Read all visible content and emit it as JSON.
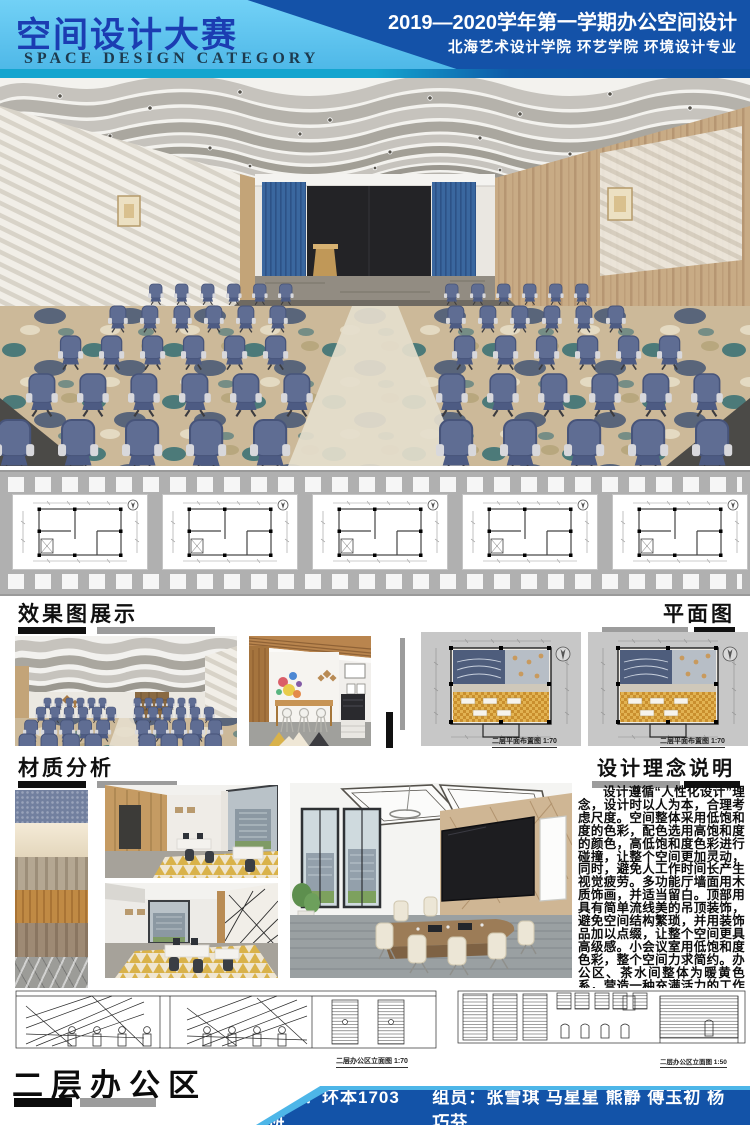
{
  "header": {
    "title_cn": "空间设计大赛",
    "title_en": "SPACE DESIGN CATEGORY",
    "semester_line": "2019—2020学年第一学期办公空间设计",
    "school_line": "北海艺术设计学院  环艺学院  环境设计专业"
  },
  "headings": {
    "renders": "效果图展示",
    "plans": "平面图",
    "materials": "材质分析",
    "concept": "设计理念说明",
    "area": "二层办公区"
  },
  "concept": {
    "paragraph": "设计遵循“人性化设计”理念，设计时以人为本，合理考虑尺度。空间整体采用低饱和度的色彩，配色选用高饱和度的颜色，高低饱和度色彩进行碰撞，让整个空间更加灵动，同时，避免人工作时间长产生视觉疲劳。多功能厅墙面用木质饰画，并适当留白。顶部用具有简单流线美的吊顶装饰，避免空间结构繁琐，并用装饰品加以点缀，让整个空间更具高级感。小会议室用低饱和度色彩，整个空间力求简约。办公区、茶水间整体为暖黄色系，营造一种充满活力的工作氛围。"
  },
  "captions": {
    "plan_left": "二层平面布置图  1:70",
    "plan_right": "二层平面布置图  1:70",
    "elevation_left": "二层办公区立面图  1:70",
    "elevation_right": "二层办公区立面图  1:50"
  },
  "footer": {
    "class_line": "班级：环本1703班",
    "members_line": "组员：张雪琪  马星星  熊静  傅玉初  杨巧芬"
  },
  "materials": {
    "swatches": [
      {
        "name": "blue-leather",
        "color": "#72809f"
      },
      {
        "name": "cream-texture",
        "color": "#f0e2c6"
      },
      {
        "name": "gray-oak",
        "color": "#b4a792"
      },
      {
        "name": "orange-wood",
        "color": "#c08a44"
      },
      {
        "name": "walnut-wood",
        "color": "#9e8a74"
      },
      {
        "name": "gray-marble",
        "color": "#9c9c98"
      }
    ]
  },
  "palette": {
    "light_blue": "#57c2ee",
    "dark_blue": "#1452a8",
    "teal_strip": "#14a5cf",
    "chair_blue": "#5f6d93",
    "curtain_blue": "#3a679f",
    "bar_gray": "#9c9c9c",
    "heading_black": "#111111"
  }
}
